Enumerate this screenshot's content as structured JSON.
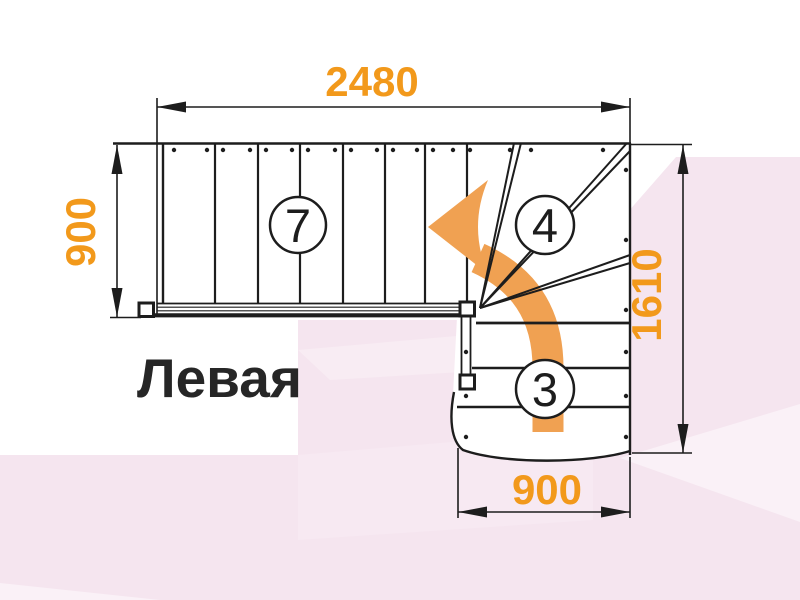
{
  "diagram": {
    "type": "staircase-plan-top-view",
    "title_label": "Левая",
    "dimensions": {
      "top_width": "2480",
      "left_depth": "900",
      "right_height": "1610",
      "bottom_width": "900"
    },
    "step_counts": {
      "upper_flight": "7",
      "winder": "4",
      "lower_flight": "3"
    },
    "colors": {
      "dimension_text": "#F2991B",
      "direction_arrow": "#F0A152",
      "line": "#1D1D1D",
      "background": "#FFFFFF",
      "background_accent_pink": "#F5E5EF"
    },
    "icons": [
      "turn-left-direction-arrow"
    ]
  }
}
